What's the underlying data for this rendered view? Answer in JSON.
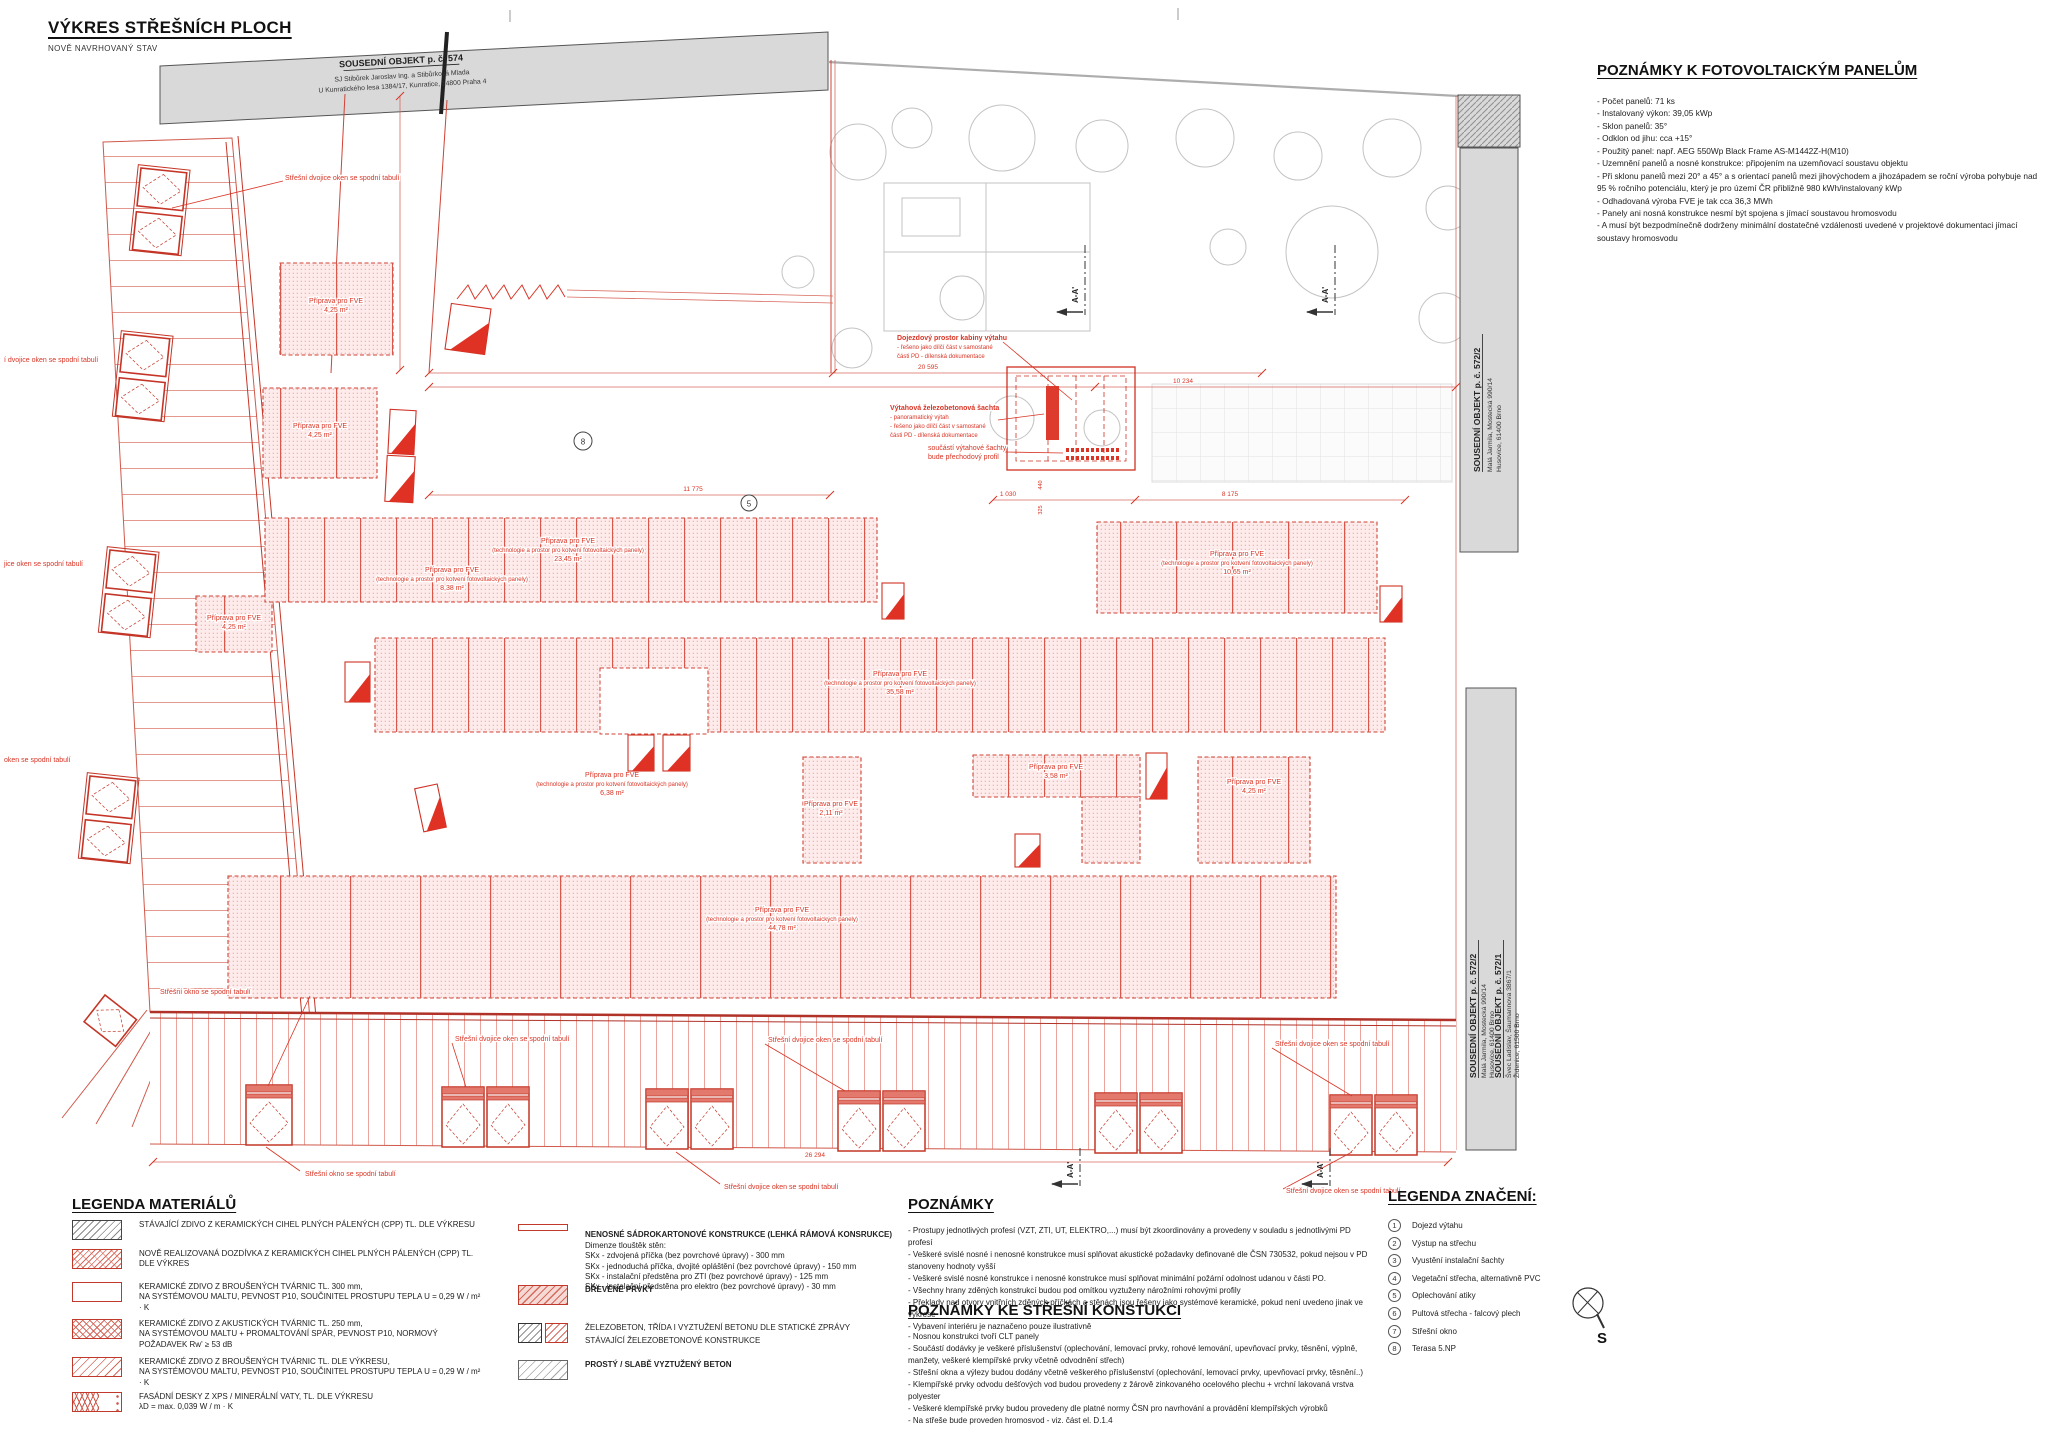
{
  "page": {
    "title": "VÝKRES STŘEŠNÍCH PLOCH",
    "subtitle": "NOVĚ NAVRHOVANÝ STAV"
  },
  "pv_notes": {
    "title": "POZNÁMKY K FOTOVOLTAICKÝM PANELŮM",
    "items": [
      "- Počet panelů: 71 ks",
      "- Instalovaný výkon: 39,05 kWp",
      "- Sklon panelů: 35°",
      "- Odklon od jihu: cca +15°",
      "- Použitý panel: např. AEG 550Wp Black Frame AS-M1442Z-H(M10)",
      "- Uzemnění panelů a nosné konstrukce: připojením na uzemňovací soustavu objektu",
      "- Při sklonu panelů mezi 20° a 45° a s orientací panelů mezi jihovýchodem a jihozápadem se roční výroba pohybuje nad 95 % ročního potenciálu, který je pro území ČR přibližně 980 kWh/instalovaný kWp",
      "- Odhadovaná výroba FVE je tak cca 36,3 MWh",
      "- Panely ani nosná konstrukce nesmí být spojena s jímací soustavou hromosvodu",
      "- A musí být bezpodmínečně dodrženy minimální dostatečné vzdálenosti uvedené v projektové dokumentaci jímací soustavy hromosvodu"
    ]
  },
  "notes": {
    "title": "POZNÁMKY",
    "items": [
      "- Prostupy jednotlivých profesí (VZT, ZTI, UT, ELEKTRO,...) musí být zkoordinovány a provedeny v souladu s jednotlivými PD profesí",
      "- Veškeré svislé nosné i nenosné konstrukce musí splňovat akustické požadavky definované dle ČSN 730532, pokud nejsou v PD stanoveny hodnoty vyšší",
      "- Veškeré svislé nosné konstrukce i nenosné konstrukce musí splňovat minimální požární odolnost udanou v části PO.",
      "- Všechny hrany zděných konstrukcí budou pod omítkou vyztuženy nárožními rohovými profily",
      "- Překlady nad otvory vnitřních zděných příčkách a stěnách jsou řešeny jako systémové keramické, pokud není uvedeno jinak ve výkrese",
      "- Vybavení interiéru je naznačeno pouze ilustrativně"
    ]
  },
  "roof_notes": {
    "title": "POZNÁMKY KE STŘEŠNÍ KONSTUKCI",
    "items": [
      "- Nosnou konstrukci tvoří CLT panely",
      "- Součástí dodávky je veškeré příslušenství (oplechování, lemovací prvky, rohové lemování, upevňovací prvky, těsnění, výplně, manžety, veškeré klempířské prvky včetně odvodnění střech)",
      "- Střešní okna a výlezy budou dodány včetně veškerého příslušenství (oplechování, lemovací prvky, upevňovací prvky, těsnění..)",
      "- Klempířské prvky odvodu dešťových vod budou provedeny z žárově zinkovaného ocelového plechu + vrchní lakovaná vrstva polyester",
      "- Veškeré klempířské prvky budou provedeny dle platné normy ČSN pro navrhování a provádění klempířských výrobků",
      "- Na střeše bude proveden hromosvod - viz. část el. D.1.4"
    ]
  },
  "legend_materials": {
    "title": "LEGENDA MATERIÁLŮ",
    "col1": [
      "STÁVAJÍCÍ ZDIVO Z KERAMICKÝCH CIHEL PLNÝCH PÁLENÝCH (CPP) TL. DLE VÝKRESU",
      "NOVĚ REALIZOVANÁ DOZDÍVKA Z KERAMICKÝCH CIHEL PLNÝCH PÁLENÝCH (CPP) TL. DLE VÝKRES",
      "KERAMICKÉ ZDIVO Z BROUŠENÝCH TVÁRNIC TL. 300 mm,\nNA SYSTÉMOVOU MALTU, PEVNOST P10, SOUČINITEL PROSTUPU TEPLA U = 0,29 W / m² · K",
      "KERAMICKÉ ZDIVO Z AKUSTICKÝCH TVÁRNIC TL. 250 mm,\nNA SYSTÉMOVOU MALTU + PROMALTOVÁNÍ SPÁR, PEVNOST P10, NORMOVÝ POŽADAVEK Rw' ≥ 53 dB",
      "KERAMICKÉ ZDIVO Z BROUŠENÝCH TVÁRNIC TL. DLE VÝKRESU,\nNA SYSTÉMOVOU MALTU, PEVNOST P10, SOUČINITEL PROSTUPU TEPLA U = 0,29 W / m² · K",
      "FASÁDNÍ DESKY Z XPS / MINERÁLNÍ VATY, TL. DLE VÝKRESU\nλD = max. 0,039 W / m · K"
    ],
    "sadro_title": "NENOSNÉ SÁDROKARTONOVÉ KONSTRUKCE (LEHKÁ RÁMOVÁ KONSRUKCE)",
    "sadro_lines": [
      "Dimenze tlouštěk stěn:",
      "SKx - zdvojená příčka (bez povrchové úpravy) - 300 mm",
      "SKx - jednoduchá příčka, dvojité opláštění (bez povrchové úpravy) - 150 mm",
      "SKx - instalační předstěna pro ZTI (bez povrchové úpravy) - 125 mm",
      "SKx - instalační předstěna pro elektro (bez povrchové úpravy) - 30 mm"
    ],
    "drevo": "DŘEVĚNÉ PRVKY",
    "zb1": "ŽELEZOBETON, TŘÍDA I VYZTUŽENÍ BETONU DLE STATICKÉ ZPRÁVY",
    "zb2": "STÁVAJÍCÍ ŽELEZOBETONOVÉ KONSTRUKCE",
    "beton": "PROSTÝ / SLABĚ VYZTUŽENÝ BETON"
  },
  "legend_symbols": {
    "title": "LEGENDA ZNAČENÍ:",
    "items": [
      {
        "n": "1",
        "t": "Dojezd výtahu"
      },
      {
        "n": "2",
        "t": "Výstup na střechu"
      },
      {
        "n": "3",
        "t": "Vyustění instalační šachty"
      },
      {
        "n": "4",
        "t": "Vegetační střecha, alternativně PVC"
      },
      {
        "n": "5",
        "t": "Oplechování atiky"
      },
      {
        "n": "6",
        "t": "Pultová střecha - falcový plech"
      },
      {
        "n": "7",
        "t": "Střešní okno"
      },
      {
        "n": "8",
        "t": "Terasa 5.NP"
      }
    ]
  },
  "compass": {
    "label": "S"
  },
  "neighbors": {
    "top": {
      "t": "SOUSEDNÍ OBJEKT p. č. 574",
      "a1": "SJ Stibůrek Jaroslav Ing. a Stibůrková Mlada",
      "a2": "U Kunratického lesa 1384/17, Kunratice, 14800 Praha 4"
    },
    "r1": {
      "t": "SOUSEDNÍ OBJEKT p. č. 572/2",
      "a1": "Malá Jarmila, Mostecká 990/14",
      "a2": "Husovice, 61400 Brno"
    },
    "r2": {
      "t": "SOUSEDNÍ OBJEKT p. č. 572/2",
      "a1": "Malá Jarmila, Mostecká 990/14",
      "a2": "Husovice, 61400 Brno"
    },
    "r3": {
      "t": "SOUSEDNÍ OBJEKT p. č. 572/1",
      "a1": "Švec Ladislav, Šaumannova 3867/1",
      "a2": "Židenice, 61500 Brno"
    }
  },
  "plan": {
    "zones": {
      "z1": {
        "n": "Příprava pro FVE",
        "a": "4,25 m²"
      },
      "z2": {
        "n": "Příprava pro FVE",
        "a": "4,25 m²"
      },
      "z3": {
        "n": "Příprava pro FVE",
        "a": "4,25 m²"
      },
      "a23": {
        "n": "Příprava pro FVE",
        "d": "(technologie a prostor pro kotvení fotovoltaických panely)",
        "a": "23,45 m²"
      },
      "a838": {
        "n": "Příprava pro FVE",
        "d": "(technologie a prostor pro kotvení fotovoltaických panely)",
        "a": "8,38 m²"
      },
      "b35": {
        "n": "Příprava pro FVE",
        "d": "(technologie a prostor pro kotvení fotovoltaických panely)",
        "a": "35,58 m²"
      },
      "b638": {
        "n": "Příprava pro FVE",
        "d": "(technologie a prostor pro kotvení fotovoltaických panely)",
        "a": "6,38 m²"
      },
      "e10": {
        "n": "Příprava pro FVE",
        "d": "(technologie a prostor pro kotvení fotovoltaických panely)",
        "a": "10,65 m²"
      },
      "c211": {
        "n": "Příprava pro FVE",
        "a": "2,11 m²"
      },
      "c358": {
        "n": "Příprava pro FVE",
        "a": "3,58 m²"
      },
      "c425": {
        "n": "Příprava pro FVE",
        "a": "4,25 m²"
      },
      "d44": {
        "n": "Příprava pro FVE",
        "d": "(technologie a prostor pro kotvení fotovoltaických panely)",
        "a": "44,78 m²"
      }
    },
    "windows": {
      "pair": "Střešní dvojice oken se spodní tabulí",
      "single": "Střešní okno se spodní tabulí",
      "cut1": "í dvojice oken se spodní tabulí",
      "cut2": "jice oken se spodní tabulí",
      "cut3": "oken se spodní tabulí"
    },
    "elev": {
      "l1a": "Dojezdový prostor kabiny výtahu",
      "l1b": "- řešeno jako dílčí část v samostané",
      "l1c": "části PD - dílenská dokumentace",
      "l2a": "Výtahová železobetonová šachta",
      "l2b": "- panoramatický výtah",
      "l2c": "- řešeno jako dílčí část v samostané",
      "l2d": "části PD - dílenská dokumentace",
      "l3a": "součástí výtahové šachty",
      "l3b": "bude přechodový profil"
    },
    "dims": {
      "d20595": "20 595",
      "d10234": "10 234",
      "d11775": "11 775",
      "d1030": "1 030",
      "d8175": "8 175",
      "d26294": "26 294",
      "d440": "440",
      "d325": "325"
    },
    "marks": {
      "c5": "5",
      "c8": "8",
      "section": "A-A'"
    }
  }
}
